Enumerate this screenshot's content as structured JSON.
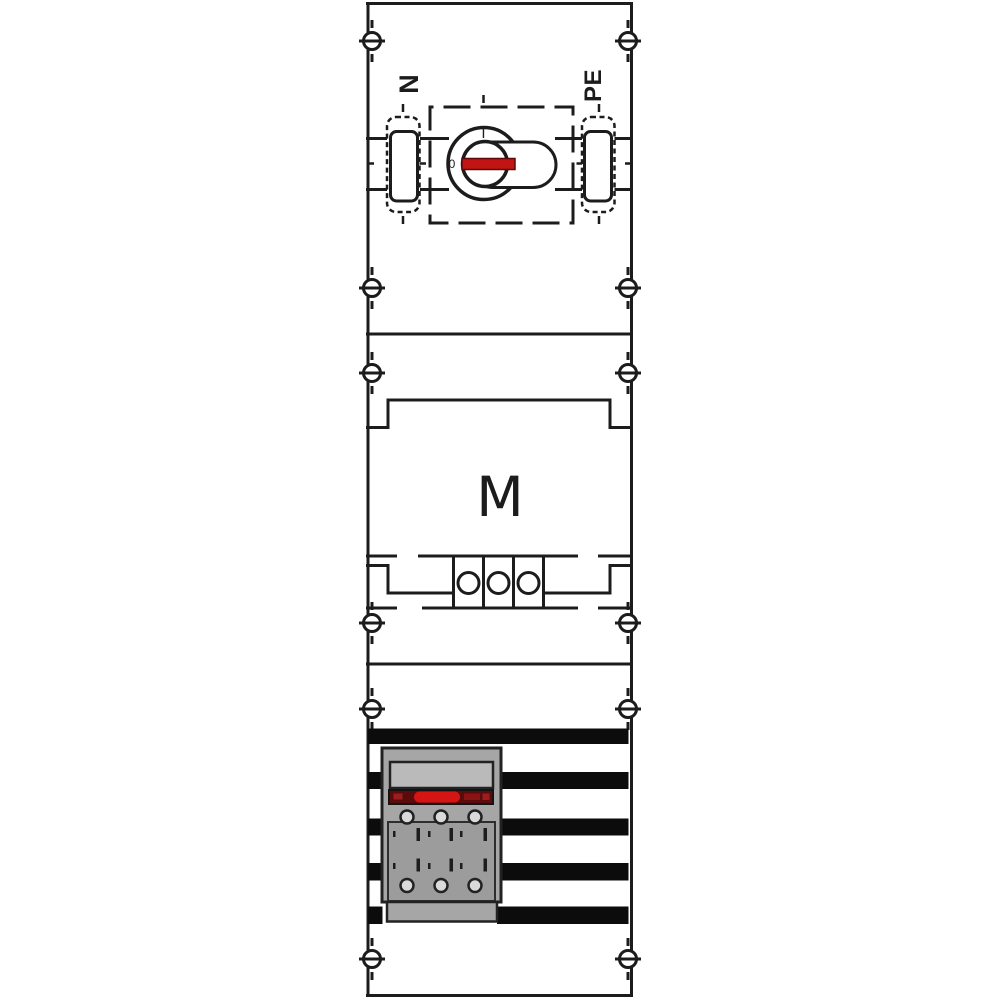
{
  "labels": {
    "n": "N",
    "pe": "PE",
    "m": "M",
    "switch_on": "I",
    "switch_off": "0"
  },
  "busbars": {
    "count": 5
  },
  "colors": {
    "line_black": "#1c1c1c",
    "busbar_black": "#0c0c0c",
    "switch_handle_red": "#c31414",
    "device_body_gray": "#a6a6a6",
    "device_panel_gray": "#bababa",
    "device_lower_gray": "#9c9c9c",
    "device_strip_dark_red": "#5a0c0c",
    "device_strip_bright_red": "#d51414"
  }
}
